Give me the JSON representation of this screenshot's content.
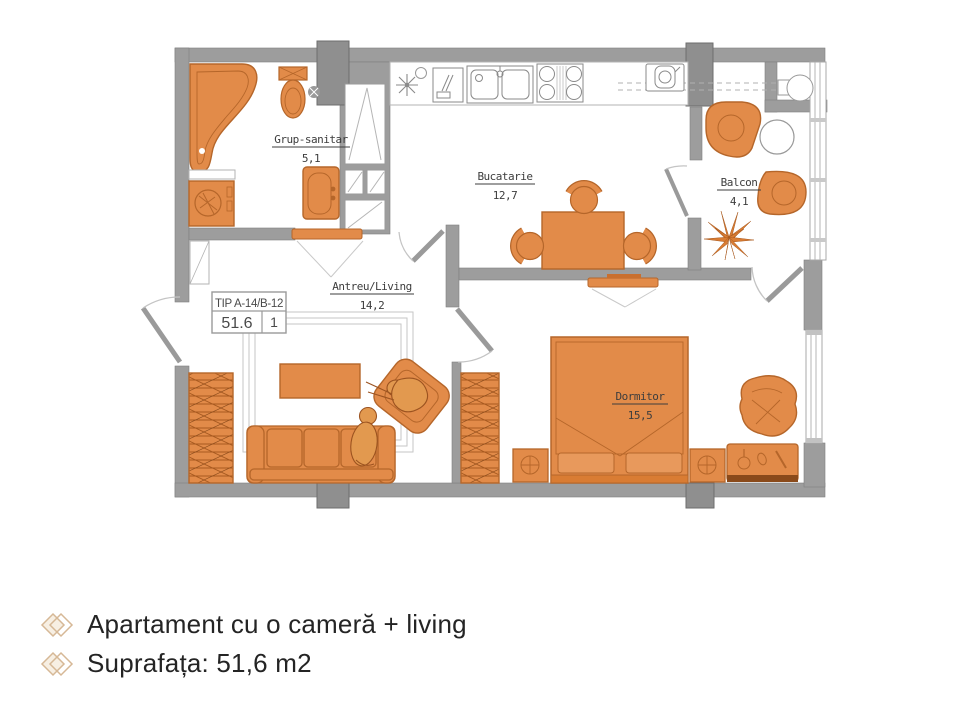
{
  "floor_plan": {
    "info_box": {
      "type": "TIP A-14/B-12",
      "area": "51.6",
      "count": "1"
    },
    "rooms": {
      "bathroom": {
        "name": "Grup-sanitar",
        "area": "5,1"
      },
      "kitchen": {
        "name": "Bucatarie",
        "area": "12,7"
      },
      "hall_living": {
        "name": "Antreu/Living",
        "area": "14,2"
      },
      "balcony": {
        "name": "Balcon",
        "area": "4,1"
      },
      "bedroom": {
        "name": "Dormitor",
        "area": "15,5"
      }
    }
  },
  "caption": {
    "title": "Apartament cu o cameră + living",
    "surface": "Suprafața: 51,6 m2"
  },
  "colors": {
    "furniture_orange": "#e28b49",
    "furniture_outline": "#b5662a",
    "wall_gray": "#9d9d9d",
    "pillar_gray": "#8f8f8f",
    "diamond_tan": "#d6b896"
  }
}
